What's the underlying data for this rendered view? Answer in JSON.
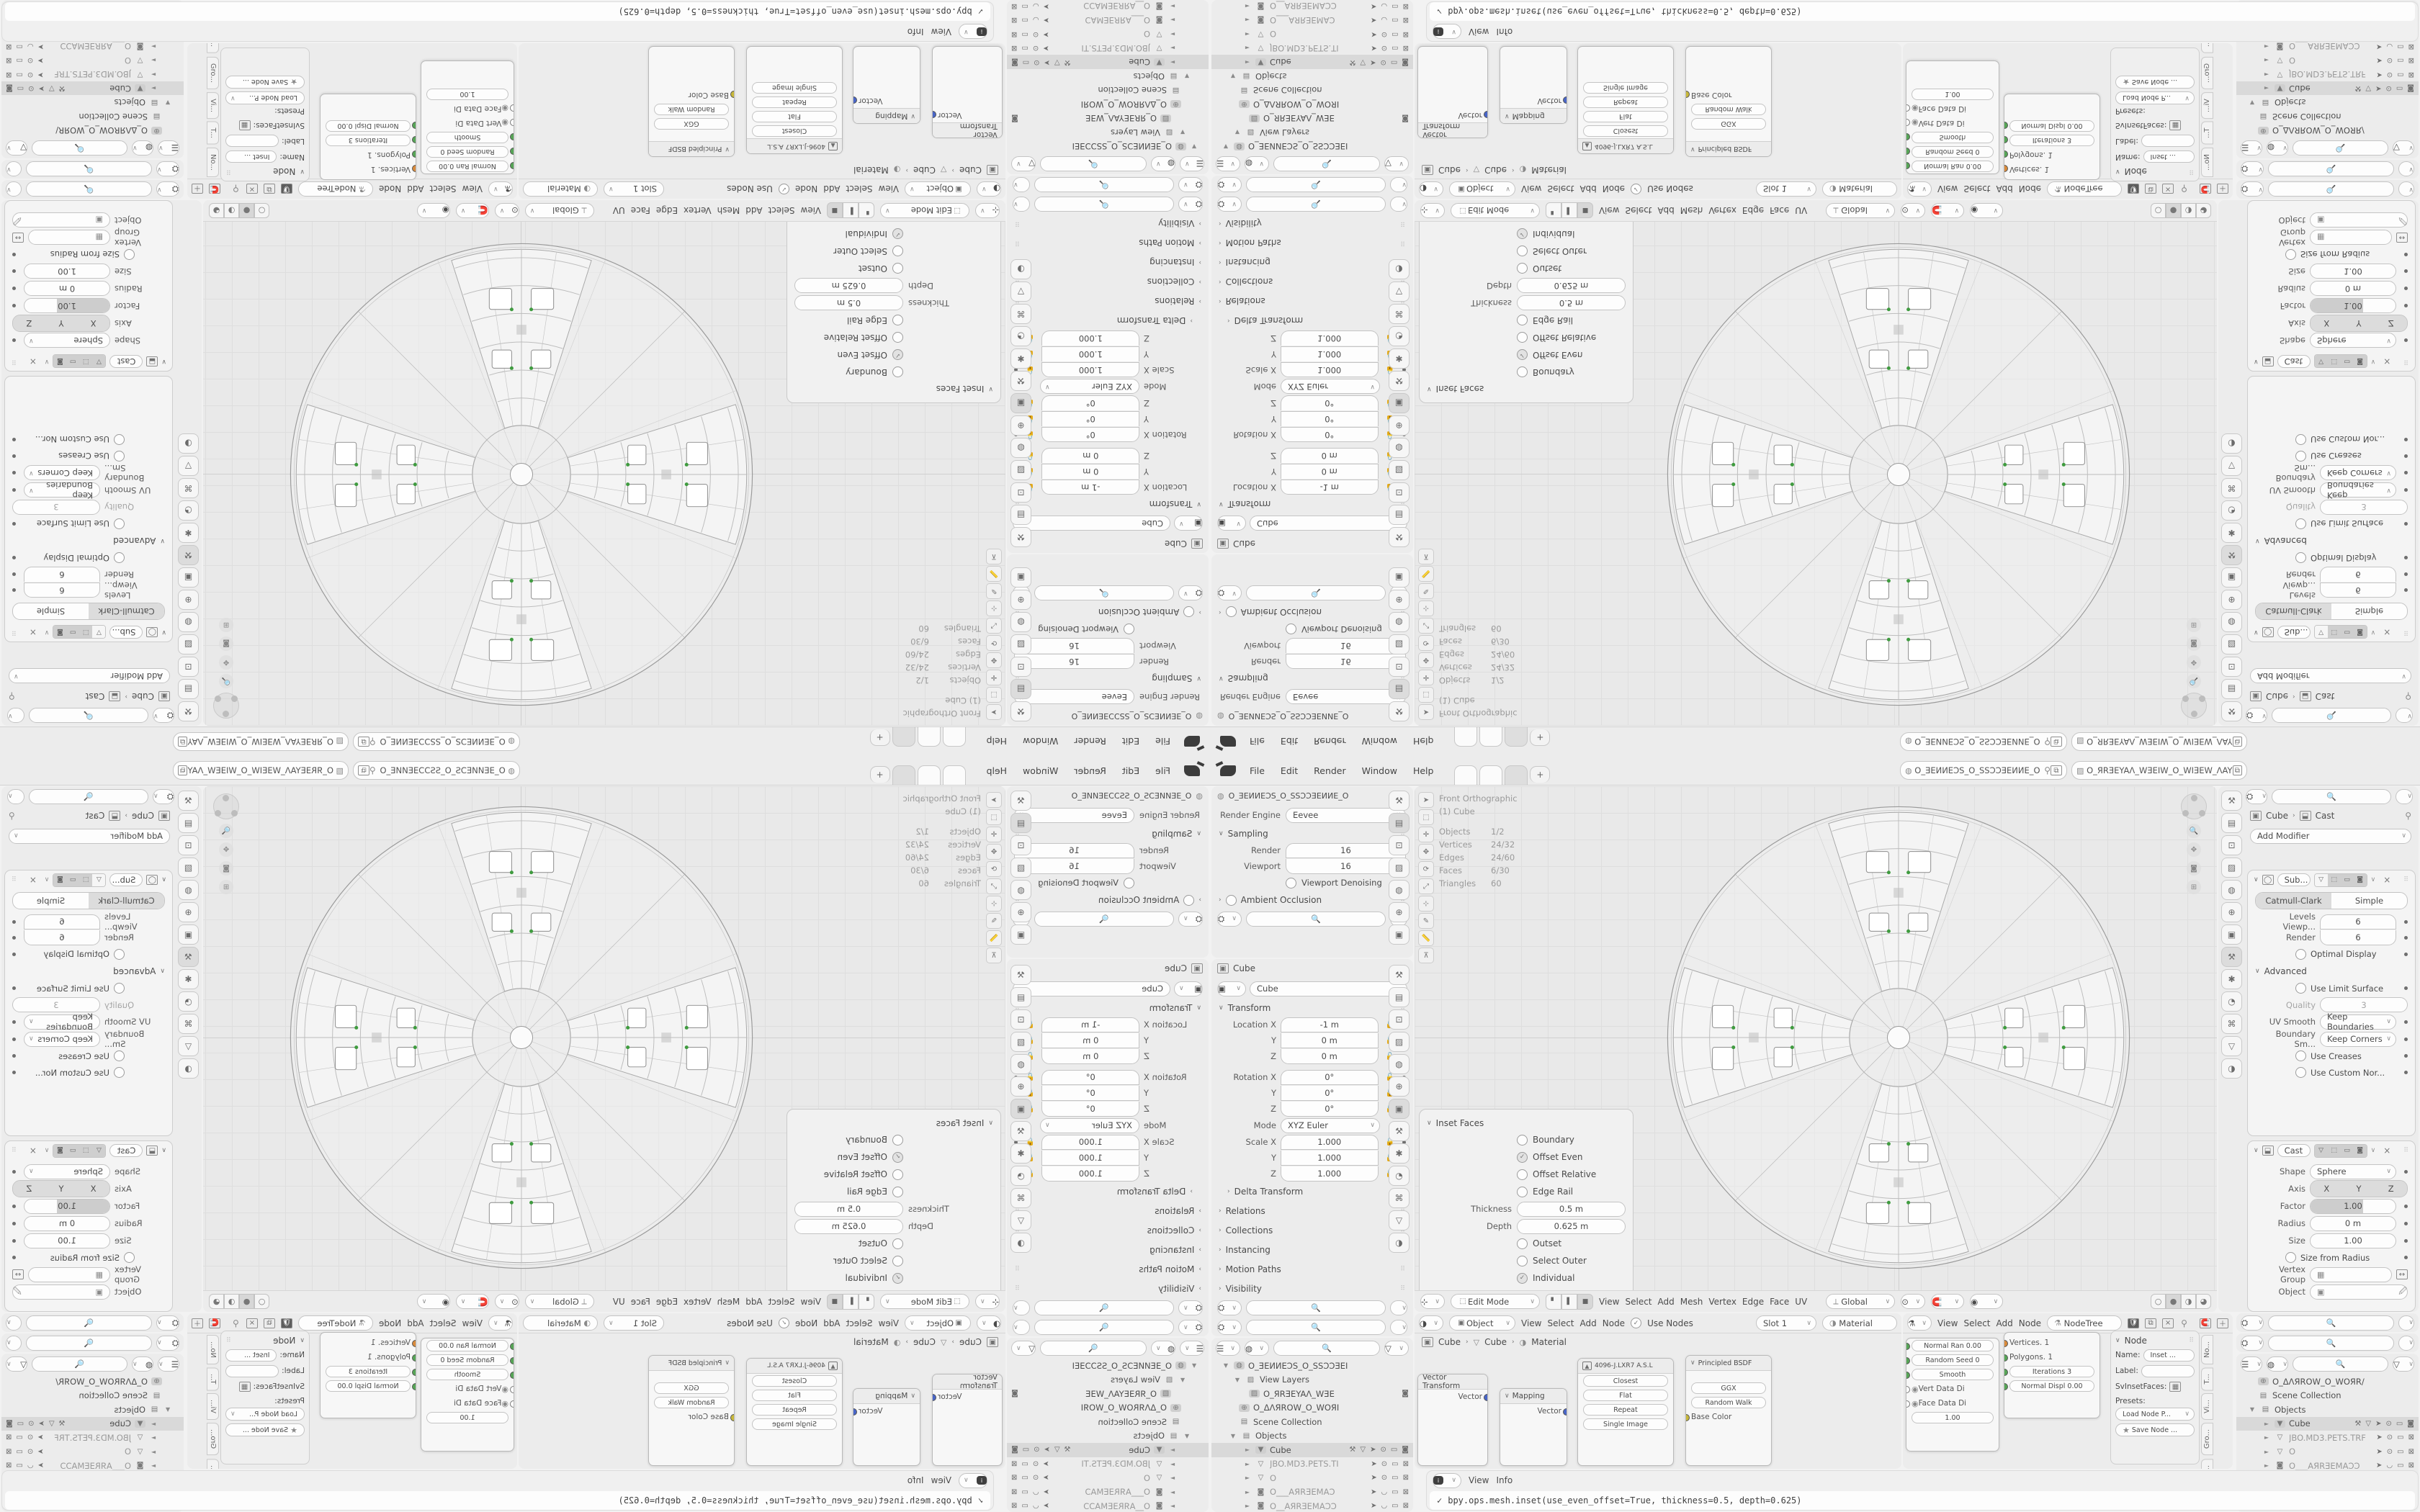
{
  "topbar": {
    "menus": [
      "File",
      "Edit",
      "Render",
      "Window",
      "Help"
    ],
    "new_tab_label": "+",
    "scene_name": "O_ƎEИИEƆS_O_SSƆƆƎEИИE_O",
    "view_layer_name": "O_ЯRƎEYAΛ_WƎEIW_O_WIƎEW_ΛAYƎEЯR_O"
  },
  "render_props": {
    "breadcrumb": "O_ƎEИИEƆS_O_SSƆƆƎEИИE_O",
    "engine_label": "Render Engine",
    "engine_value": "Eevee",
    "sampling_title": "Sampling",
    "render_label": "Render",
    "render_value": "16",
    "viewport_label": "Viewport",
    "viewport_value": "16",
    "denoising_label": "Viewport Denoising",
    "ao_label": "Ambient Occlusion"
  },
  "object_props": {
    "breadcrumb": "Cube",
    "name_value": "Cube",
    "transform_title": "Transform",
    "transform_rows": [
      {
        "label": "Location X",
        "value": "-1 m"
      },
      {
        "label": "Y",
        "value": "0 m"
      },
      {
        "label": "Z",
        "value": "0 m"
      },
      {
        "label": "Rotation X",
        "value": "0°"
      },
      {
        "label": "Y",
        "value": "0°"
      },
      {
        "label": "Z",
        "value": "0°"
      },
      {
        "label": "Mode",
        "value": "XYZ Euler"
      },
      {
        "label": "Scale X",
        "value": "1.000"
      },
      {
        "label": "Y",
        "value": "1.000"
      },
      {
        "label": "Z",
        "value": "1.000"
      }
    ],
    "collapsed_sections": [
      "Delta Transform",
      "Relations",
      "Collections",
      "Instancing",
      "Motion Paths",
      "Visibility"
    ]
  },
  "outliner_left": {
    "items": [
      {
        "arrow": "▼",
        "glyph": "◍",
        "label": "O_ƎEИИEƆS_O_SSƆƆƎEI"
      },
      {
        "arrow": "▼",
        "glyph": "▨",
        "label": "View Layers"
      },
      {
        "arrow": "",
        "glyph": "▨",
        "label": "O_ЯRƎEYAΛ_WƎE"
      },
      {
        "arrow": "",
        "glyph": "⊕",
        "label": "O_ΔΛЯROW_O_WOЯI"
      },
      {
        "arrow": "",
        "glyph": "▤",
        "label": "Scene Collection"
      },
      {
        "arrow": "▼",
        "glyph": "▤",
        "label": "Objects"
      },
      {
        "arrow": "►",
        "glyph": "▼",
        "label": "Cube"
      },
      {
        "arrow": "►",
        "glyph": "▽",
        "label": "JBO.MD3.PETS.TI"
      },
      {
        "arrow": "►",
        "glyph": "▽",
        "label": "O"
      },
      {
        "arrow": "►",
        "glyph": "◙",
        "label": "O___AЯRƎEMAƆ"
      },
      {
        "arrow": "►",
        "glyph": "◙",
        "label": "O__AЯRƎEMAƆƆ"
      }
    ]
  },
  "viewport": {
    "overlay": {
      "view_name": "Front Orthographic",
      "active_object": "(1) Cube",
      "stats": [
        {
          "label": "Objects",
          "value": "1/2"
        },
        {
          "label": "Vertices",
          "value": "24/32"
        },
        {
          "label": "Edges",
          "value": "24/60"
        },
        {
          "label": "Faces",
          "value": "6/30"
        },
        {
          "label": "Triangles",
          "value": "60"
        }
      ]
    },
    "header": {
      "mode": "Edit Mode",
      "menus": [
        "View",
        "Select",
        "Add",
        "Mesh",
        "Vertex",
        "Edge",
        "Face",
        "UV"
      ],
      "orientation": "Global"
    },
    "inset_panel": {
      "title": "Inset Faces",
      "checks_top": [
        {
          "label": "Boundary",
          "on": false
        },
        {
          "label": "Offset Even",
          "on": true
        },
        {
          "label": "Offset Relative",
          "on": false
        },
        {
          "label": "Edge Rail",
          "on": false
        }
      ],
      "fields": [
        {
          "label": "Thickness",
          "value": "0.5 m"
        },
        {
          "label": "Depth",
          "value": "0.625 m"
        }
      ],
      "checks_bottom": [
        {
          "label": "Outset",
          "on": false
        },
        {
          "label": "Select Outer",
          "on": false
        },
        {
          "label": "Individual",
          "on": true
        },
        {
          "label": "Interpolate",
          "on": true
        }
      ]
    }
  },
  "shader_editor": {
    "header": {
      "type_value": "Object",
      "menus": [
        "View",
        "Select",
        "Add",
        "Node"
      ],
      "use_nodes": "Use Nodes",
      "slot": "Slot 1",
      "material": "Material"
    },
    "breadcrumb": [
      "Cube",
      "Cube",
      "Material"
    ],
    "vector_transform_node": {
      "title": "Vector Transform",
      "socket": "Vector"
    },
    "mapping_node": {
      "title": "Mapping",
      "socket": "Vector"
    },
    "image_texture_node": {
      "title": "4096-J.LXR7 A.S.L",
      "rows": [
        "Closest",
        "Flat",
        "Repeat",
        "Single Image"
      ]
    },
    "principled_node": {
      "title": "Principled BSDF",
      "rows": [
        "GGX",
        "Random Walk",
        "Base Color"
      ]
    }
  },
  "sverchok_editor": {
    "header": {
      "menus": [
        "View",
        "Select",
        "Add",
        "Node"
      ],
      "tree_name": "NodeTree"
    },
    "inset_node_rows": [
      "Normal Ran  0.00",
      "Random Seed  0",
      "Smooth",
      "Vert Data Di",
      "Face Data Di",
      "1.00"
    ],
    "mesh_node_rows": [
      "Vertices. 1",
      "Polygons. 1",
      "Iterations  3",
      "Normal Displ  0.00"
    ],
    "npanel": {
      "section": "Node",
      "name_label": "Name:",
      "name_value": "Inset ...",
      "label_label": "Label:",
      "preset_class": "SvInsetFaces:",
      "presets_label": "Presets:",
      "load_label": "Load Node P...",
      "save_label": "Save Node ...",
      "tabs": [
        "No...",
        "T...",
        "Vi...",
        "Gro...",
        "Sverc..."
      ]
    }
  },
  "modifier_props": {
    "breadcrumb": [
      "Cube",
      "Cast"
    ],
    "add_modifier": "Add Modifier",
    "subdivision": {
      "name": "Sub...",
      "algo_tabs": [
        "Catmull-Clark",
        "Simple"
      ],
      "active_algo": 0,
      "levels_label": "Levels Viewp...",
      "levels_value": "6",
      "render_label": "Render",
      "render_value": "6",
      "optimal_label": "Optimal Display",
      "advanced_title": "Advanced",
      "use_limit_label": "Use Limit Surface",
      "quality_label": "Quality",
      "quality_value": "3",
      "uv_smooth_label": "UV Smooth",
      "uv_smooth_value": "Keep Boundaries",
      "boundary_label": "Boundary Sm...",
      "boundary_value": "Keep Corners",
      "use_creases_label": "Use Creases",
      "use_custom_label": "Use Custom Nor..."
    },
    "cast": {
      "name": "Cast",
      "shape_label": "Shape",
      "shape_value": "Sphere",
      "axis_label": "Axis",
      "axis": [
        "X",
        "Y",
        "Z"
      ],
      "factor_label": "Factor",
      "factor_value": "1.00",
      "radius_label": "Radius",
      "radius_value": "0 m",
      "size_label": "Size",
      "size_value": "1.00",
      "size_from_label": "Size from Radius",
      "vgroup_label": "Vertex Group",
      "object_label": "Object"
    }
  },
  "outliner_right": {
    "items": [
      {
        "arrow": "",
        "glyph": "⊕",
        "label": "O_ΔΛЯROW_O_WOЯR/"
      },
      {
        "arrow": "",
        "glyph": "▤",
        "label": "Scene Collection"
      },
      {
        "arrow": "▼",
        "glyph": "▤",
        "label": "Objects"
      },
      {
        "arrow": "►",
        "glyph": "▼",
        "label": "Cube"
      },
      {
        "arrow": "►",
        "glyph": "▽",
        "label": "JBO.MD3.PETS.TRF"
      },
      {
        "arrow": "►",
        "glyph": "▽",
        "label": "O"
      },
      {
        "arrow": "►",
        "glyph": "◙",
        "label": "O___AЯRƎEMAƆƆ"
      },
      {
        "arrow": "►",
        "glyph": "◙",
        "label": "O__AЯRƎEMAƆƆAI"
      },
      {
        "arrow": "►",
        "glyph": "▽",
        "label": "Object"
      },
      {
        "arrow": "►",
        "glyph": "▽",
        "label": "Plane"
      },
      {
        "arrow": "►",
        "glyph": "▽",
        "label": "SBINEL"
      }
    ]
  },
  "info_editor": {
    "menus": [
      "View",
      "Info"
    ],
    "log_line": "bpy.ops.mesh.inset(use_even_offset=True, thickness=0.5, depth=0.625)"
  },
  "colors": {
    "area_bg": "#ececec",
    "viewport_bg": "#e9e9e9",
    "highlight": "#d9d9d9",
    "socket_green": "#56a556",
    "socket_orange": "#d98a3a",
    "socket_yellow": "#c8b83a",
    "socket_blue": "#4865c8"
  }
}
